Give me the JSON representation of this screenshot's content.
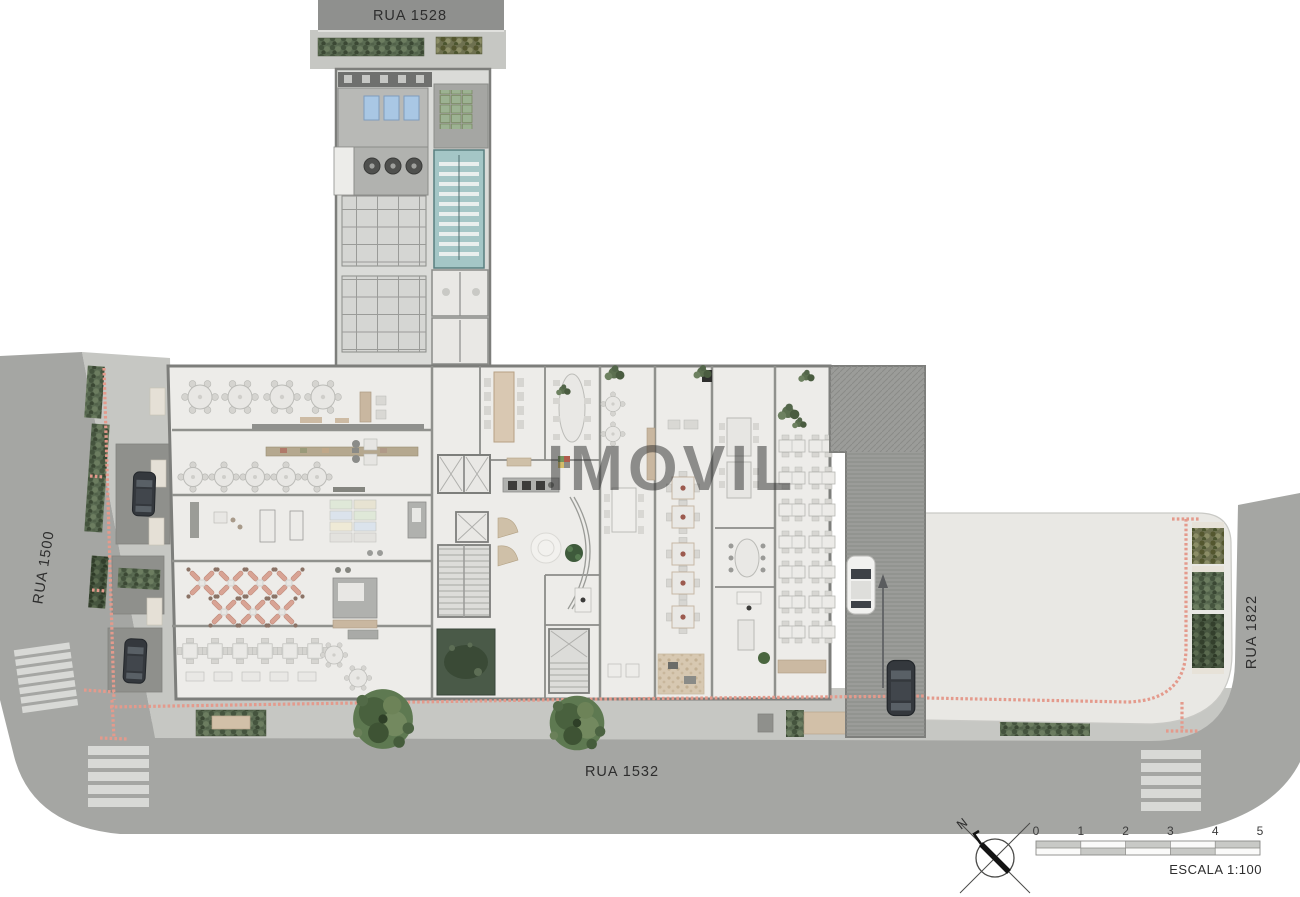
{
  "plan": {
    "watermark": "IMOVIL",
    "streets": {
      "top": "RUA 1528",
      "left": "RUA 1500",
      "bottom": "RUA 1532",
      "right": "RUA 1822"
    },
    "legend": {
      "north_label": "N",
      "scale_ticks": [
        "0",
        "1",
        "2",
        "3",
        "4",
        "5"
      ],
      "scale_label": "ESCALA 1:100"
    },
    "colors": {
      "road": "#a5a6a3",
      "road_top": "#8f908e",
      "sidewalk": "#c6c7c3",
      "building_floor": "#edece9",
      "tower_floor": "#dadbd8",
      "wall": "#7d7e7b",
      "parking_lot": "#e9e8e4",
      "ramp_hatch": "#9b9c99",
      "tactile_paving": "#e49a8c",
      "stair_teal": "#a4c6c6",
      "skylight_blue": "#a9c7e4",
      "garden_green": "#4a5a48",
      "hedge_green": "#5a6b52",
      "crosswalk": "#d8d9d6"
    }
  }
}
